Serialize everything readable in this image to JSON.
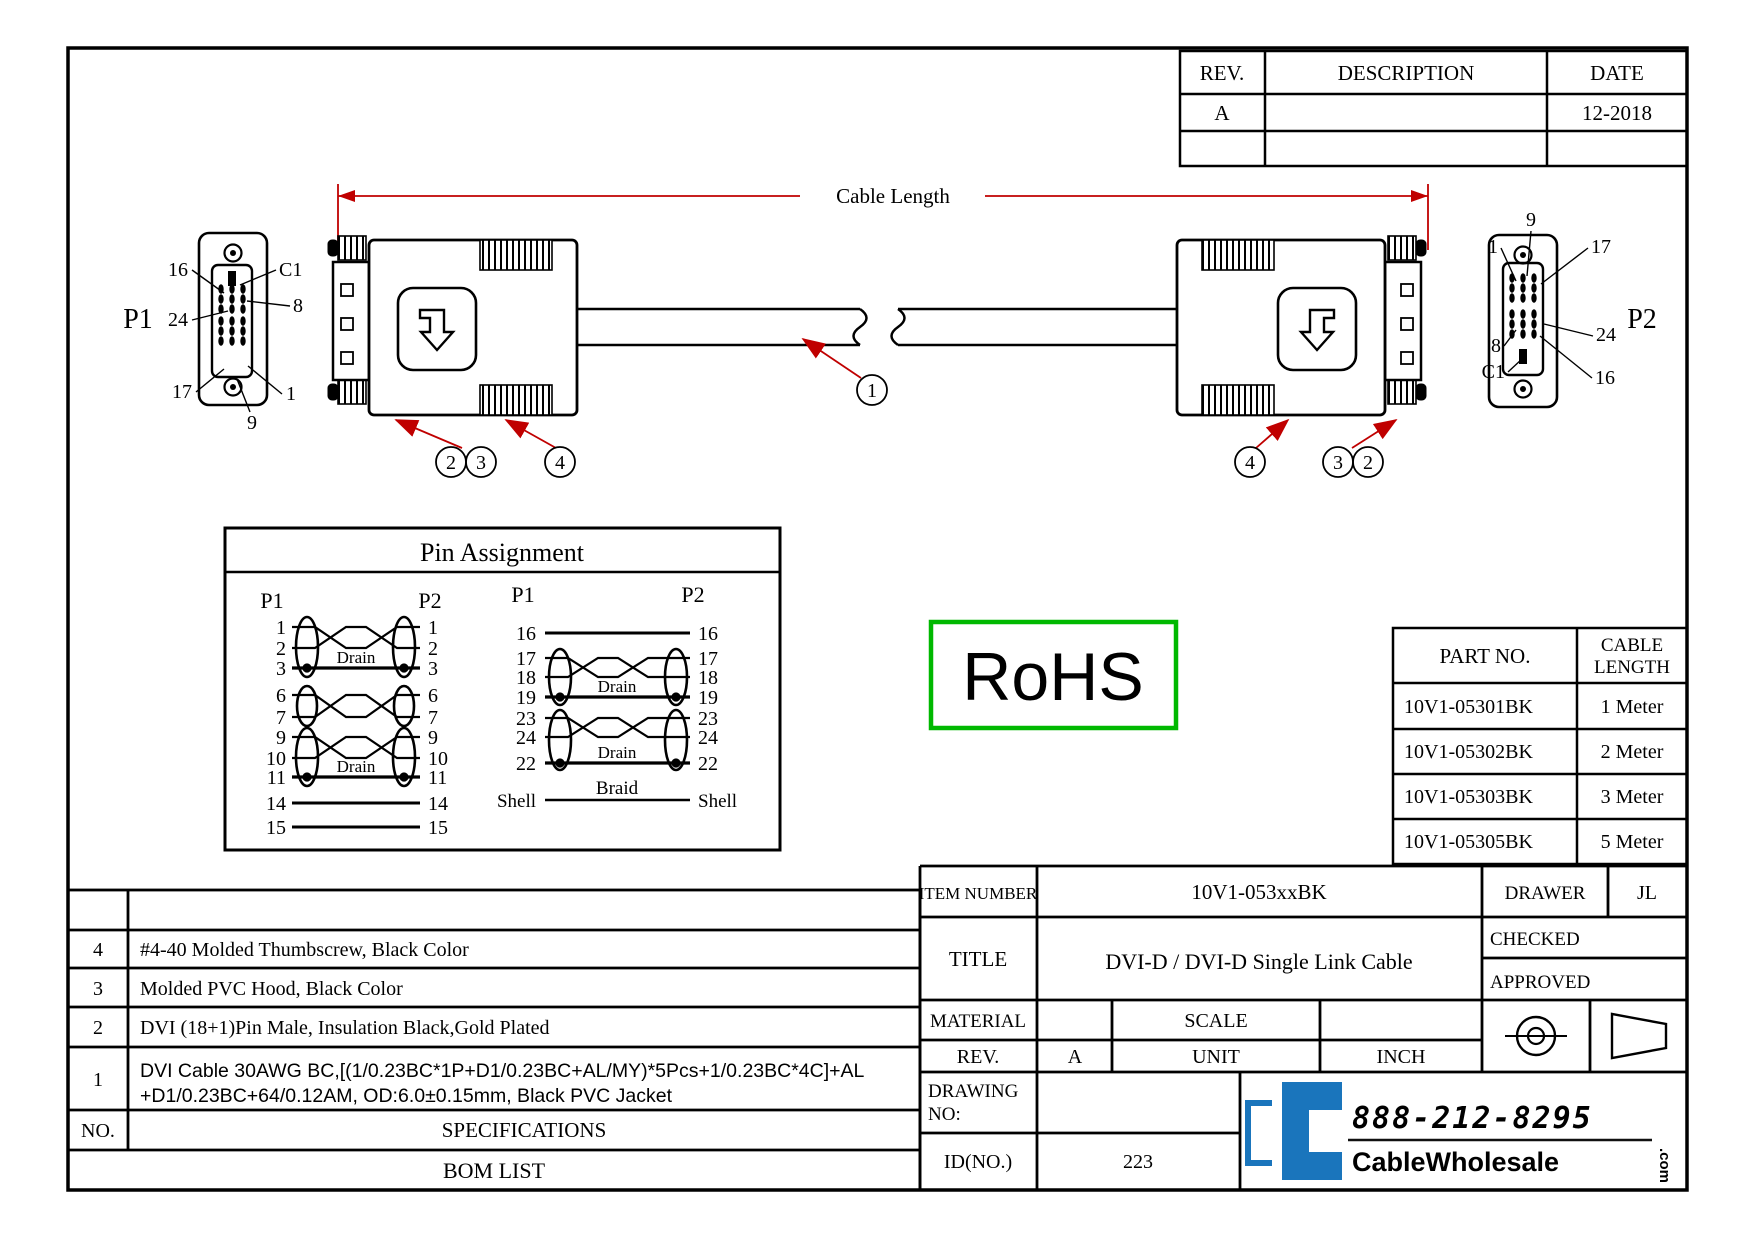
{
  "revision_table": {
    "headers": [
      "REV.",
      "DESCRIPTION",
      "DATE"
    ],
    "rows": [
      {
        "rev": "A",
        "description": "",
        "date": "12-2018"
      },
      {
        "rev": "",
        "description": "",
        "date": ""
      }
    ]
  },
  "drawing": {
    "cable_length_label": "Cable Length",
    "p1_label": "P1",
    "p2_label": "P2",
    "callouts": {
      "n1": "1",
      "n2": "2",
      "n3": "3",
      "n4": "4"
    },
    "p1_face_pins": {
      "tl": "16",
      "tr": "C1",
      "ml": "24",
      "mr": "8",
      "bl": "17",
      "br": "1",
      "b": "9"
    },
    "p2_face_pins": {
      "t": "9",
      "tl": "1",
      "tr": "17",
      "ml": "8",
      "mr": "24",
      "bl": "C1",
      "br": "16"
    }
  },
  "pin_assignment": {
    "title": "Pin Assignment",
    "p1_label": "P1",
    "p2_label": "P2",
    "drain_label": "Drain",
    "shell_label": "Shell",
    "braid_label": "Braid",
    "left_pins": [
      "1",
      "2",
      "3",
      "6",
      "7",
      "9",
      "10",
      "11",
      "14",
      "15"
    ],
    "right_pins": [
      "16",
      "17",
      "18",
      "19",
      "23",
      "24",
      "22"
    ]
  },
  "rohs_label": "RoHS",
  "parts_table": {
    "col1_header": "PART NO.",
    "col2_header_line1": "CABLE",
    "col2_header_line2": "LENGTH",
    "rows": [
      {
        "part": "10V1-05301BK",
        "length": "1 Meter"
      },
      {
        "part": "10V1-05302BK",
        "length": "2 Meter"
      },
      {
        "part": "10V1-05303BK",
        "length": "3 Meter"
      },
      {
        "part": "10V1-05305BK",
        "length": "5 Meter"
      }
    ]
  },
  "bom": {
    "rows": [
      {
        "no": "4",
        "spec": "#4-40 Molded Thumbscrew, Black Color"
      },
      {
        "no": "3",
        "spec": "Molded PVC Hood, Black Color"
      },
      {
        "no": "2",
        "spec": "DVI (18+1)Pin Male, Insulation Black,Gold Plated"
      },
      {
        "no": "1",
        "spec_line1": "DVI Cable 30AWG BC,[(1/0.23BC*1P+D1/0.23BC+AL/MY)*5Pcs+1/0.23BC*4C]+AL",
        "spec_line2": "+D1/0.23BC+64/0.12AM, OD:6.0±0.15mm, Black PVC Jacket"
      }
    ],
    "no_header": "NO.",
    "spec_header": "SPECIFICATIONS",
    "title": "BOM LIST"
  },
  "title_block": {
    "item_number_label": "ITEM NUMBER",
    "item_number": "10V1-053xxBK",
    "drawer_label": "DRAWER",
    "drawer": "JL",
    "title_label": "TITLE",
    "title": "DVI-D / DVI-D Single Link Cable",
    "checked_label": "CHECKED",
    "approved_label": "APPROVED",
    "material_label": "MATERIAL",
    "material": "",
    "scale_label": "SCALE",
    "scale": "",
    "rev_label": "REV.",
    "rev": "A",
    "unit_label": "UNIT",
    "unit_value": "INCH",
    "drawing_no_label_line1": "DRAWING",
    "drawing_no_label_line2": "NO:",
    "drawing_no": "",
    "id_label": "ID(NO.)",
    "id_value": "223"
  },
  "logo": {
    "phone": "888-212-8295",
    "brand": "CableWholesale",
    "tld": ".com"
  },
  "colors": {
    "accent_red": "#c00000",
    "rohs_green": "#00b800",
    "logo_blue": "#1a75bc"
  }
}
